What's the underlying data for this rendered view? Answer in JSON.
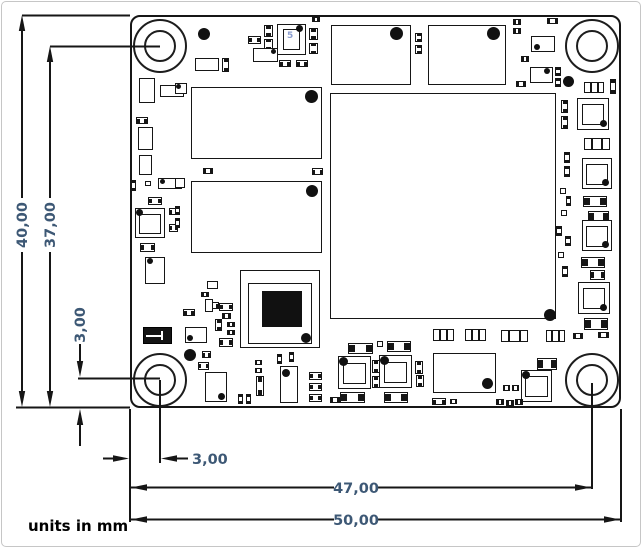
{
  "annotation": {
    "units_label": "units in mm",
    "dims": {
      "v_overall": "40,00",
      "v_hole_to_bottom": "37,00",
      "v_hole_offset": "3,00",
      "h_hole_offset": "3,00",
      "h_edge_to_hole": "47,00",
      "h_overall": "50,00"
    }
  },
  "colors": {
    "dimension_text": "#3d5875",
    "outline": "#161616",
    "background": "#ffffff",
    "chip_marking": "#8d9fd1"
  },
  "pcb": {
    "board": {
      "x": 130,
      "y": 15,
      "w": 491,
      "h": 393,
      "width_mm": "50,00",
      "height_mm": "40,00",
      "hole_offset_mm": "3,00"
    },
    "holes": [
      {
        "cx": 160,
        "cy": 46
      },
      {
        "cx": 592,
        "cy": 46
      },
      {
        "cx": 160,
        "cy": 380
      },
      {
        "cx": 592,
        "cy": 380
      }
    ],
    "hole_outer_d": 54,
    "components": [
      {
        "t": "dot",
        "x": 204,
        "y": 34,
        "d": 12
      },
      {
        "t": "r",
        "x": 195,
        "y": 58,
        "w": 24,
        "h": 13
      },
      {
        "t": "c2v",
        "x": 222,
        "y": 58,
        "w": 7,
        "h": 14
      },
      {
        "t": "c2h",
        "x": 248,
        "y": 36,
        "w": 13,
        "h": 8
      },
      {
        "t": "c2v",
        "x": 264,
        "y": 25,
        "w": 9,
        "h": 12
      },
      {
        "t": "c2v",
        "x": 264,
        "y": 39,
        "w": 9,
        "h": 11
      },
      {
        "t": "r",
        "x": 277,
        "y": 24,
        "w": 29,
        "h": 31,
        "n": "oscillator"
      },
      {
        "t": "r",
        "x": 283,
        "y": 29,
        "w": 17,
        "h": 21
      },
      {
        "t": "txt",
        "x": 287,
        "y": 32,
        "s": "5",
        "n": "chip-marking"
      },
      {
        "t": "dot",
        "x": 299,
        "y": 28,
        "d": 7
      },
      {
        "t": "c2v",
        "x": 309,
        "y": 28,
        "w": 9,
        "h": 12
      },
      {
        "t": "c2v",
        "x": 309,
        "y": 43,
        "w": 9,
        "h": 11
      },
      {
        "t": "c2h",
        "x": 312,
        "y": 17,
        "w": 8,
        "h": 5
      },
      {
        "t": "r",
        "x": 253,
        "y": 48,
        "w": 25,
        "h": 14
      },
      {
        "t": "dot",
        "x": 273,
        "y": 51,
        "d": 5
      },
      {
        "t": "c2h",
        "x": 279,
        "y": 60,
        "w": 12,
        "h": 7
      },
      {
        "t": "c2h",
        "x": 296,
        "y": 60,
        "w": 12,
        "h": 7
      },
      {
        "t": "r",
        "x": 331,
        "y": 25,
        "w": 80,
        "h": 60,
        "n": "top-ic-1"
      },
      {
        "t": "dot",
        "x": 396,
        "y": 33,
        "d": 13
      },
      {
        "t": "c2v",
        "x": 415,
        "y": 33,
        "w": 7,
        "h": 9
      },
      {
        "t": "c2v",
        "x": 415,
        "y": 45,
        "w": 7,
        "h": 9
      },
      {
        "t": "r",
        "x": 428,
        "y": 25,
        "w": 78,
        "h": 60,
        "n": "top-ic-2"
      },
      {
        "t": "dot",
        "x": 493,
        "y": 33,
        "d": 13
      },
      {
        "t": "c2h",
        "x": 513,
        "y": 19,
        "w": 8,
        "h": 6
      },
      {
        "t": "c2h",
        "x": 513,
        "y": 28,
        "w": 8,
        "h": 6
      },
      {
        "t": "c2h",
        "x": 547,
        "y": 18,
        "w": 11,
        "h": 6
      },
      {
        "t": "r",
        "x": 531,
        "y": 36,
        "w": 24,
        "h": 16
      },
      {
        "t": "dot",
        "x": 537,
        "y": 47,
        "d": 6
      },
      {
        "t": "c2h",
        "x": 521,
        "y": 56,
        "w": 8,
        "h": 6
      },
      {
        "t": "r",
        "x": 530,
        "y": 67,
        "w": 23,
        "h": 16
      },
      {
        "t": "dot",
        "x": 547,
        "y": 71,
        "d": 6
      },
      {
        "t": "c2h",
        "x": 516,
        "y": 81,
        "w": 10,
        "h": 6
      },
      {
        "t": "c2v",
        "x": 555,
        "y": 67,
        "w": 6,
        "h": 9
      },
      {
        "t": "c2v",
        "x": 555,
        "y": 78,
        "w": 6,
        "h": 9
      },
      {
        "t": "dot",
        "x": 568,
        "y": 81,
        "d": 11
      },
      {
        "t": "c3h",
        "x": 584,
        "y": 82,
        "w": 20,
        "h": 11
      },
      {
        "t": "c2v",
        "x": 610,
        "y": 79,
        "w": 6,
        "h": 15
      },
      {
        "t": "r",
        "x": 191,
        "y": 87,
        "w": 131,
        "h": 72,
        "n": "memory-chip-1"
      },
      {
        "t": "dot",
        "x": 311,
        "y": 96,
        "d": 13
      },
      {
        "t": "r",
        "x": 191,
        "y": 181,
        "w": 131,
        "h": 72,
        "n": "memory-chip-2"
      },
      {
        "t": "dot",
        "x": 312,
        "y": 191,
        "d": 12
      },
      {
        "t": "r",
        "x": 330,
        "y": 93,
        "w": 226,
        "h": 226,
        "n": "soc-chip"
      },
      {
        "t": "dot",
        "x": 550,
        "y": 315,
        "d": 12
      },
      {
        "t": "r",
        "x": 139,
        "y": 78,
        "w": 16,
        "h": 25
      },
      {
        "t": "r",
        "x": 160,
        "y": 85,
        "w": 24,
        "h": 12
      },
      {
        "t": "dot",
        "x": 178,
        "y": 88,
        "d": 5
      },
      {
        "t": "c2h",
        "x": 136,
        "y": 117,
        "w": 12,
        "h": 7
      },
      {
        "t": "r",
        "x": 138,
        "y": 127,
        "w": 15,
        "h": 23
      },
      {
        "t": "r",
        "x": 139,
        "y": 155,
        "w": 13,
        "h": 20
      },
      {
        "t": "c2v",
        "x": 131,
        "y": 180,
        "w": 5,
        "h": 11
      },
      {
        "t": "r",
        "x": 145,
        "y": 181,
        "w": 6,
        "h": 5
      },
      {
        "t": "r",
        "x": 158,
        "y": 178,
        "w": 24,
        "h": 11
      },
      {
        "t": "dot",
        "x": 162,
        "y": 181,
        "d": 5
      },
      {
        "t": "c2h",
        "x": 148,
        "y": 197,
        "w": 14,
        "h": 8
      },
      {
        "t": "ind",
        "x": 135,
        "y": 208,
        "w": 30,
        "h": 30
      },
      {
        "t": "dot",
        "x": 139,
        "y": 212,
        "d": 7
      },
      {
        "t": "c2h",
        "x": 169,
        "y": 208,
        "w": 9,
        "h": 7
      },
      {
        "t": "c2h",
        "x": 169,
        "y": 224,
        "w": 9,
        "h": 8
      },
      {
        "t": "c2h",
        "x": 140,
        "y": 243,
        "w": 15,
        "h": 9
      },
      {
        "t": "r",
        "x": 145,
        "y": 257,
        "w": 20,
        "h": 27
      },
      {
        "t": "dot",
        "x": 150,
        "y": 261,
        "d": 6
      },
      {
        "t": "r",
        "x": 175,
        "y": 83,
        "w": 12,
        "h": 11
      },
      {
        "t": "dot",
        "x": 178,
        "y": 86,
        "d": 5
      },
      {
        "t": "c2h",
        "x": 203,
        "y": 168,
        "w": 10,
        "h": 6
      },
      {
        "t": "c2h",
        "x": 312,
        "y": 168,
        "w": 11,
        "h": 7
      },
      {
        "t": "r",
        "x": 175,
        "y": 178,
        "w": 10,
        "h": 10
      },
      {
        "t": "c2v",
        "x": 175,
        "y": 206,
        "w": 5,
        "h": 9
      },
      {
        "t": "c2v",
        "x": 175,
        "y": 218,
        "w": 5,
        "h": 10
      },
      {
        "t": "r",
        "x": 207,
        "y": 281,
        "w": 11,
        "h": 8
      },
      {
        "t": "c2h",
        "x": 201,
        "y": 292,
        "w": 8,
        "h": 5
      },
      {
        "t": "c2h",
        "x": 208,
        "y": 302,
        "w": 11,
        "h": 7
      },
      {
        "t": "xb",
        "x": 143,
        "y": 327,
        "w": 29,
        "h": 17,
        "n": "black-crystal"
      },
      {
        "t": "c2h",
        "x": 183,
        "y": 309,
        "w": 12,
        "h": 7
      },
      {
        "t": "r",
        "x": 205,
        "y": 299,
        "w": 8,
        "h": 13
      },
      {
        "t": "c2h",
        "x": 219,
        "y": 303,
        "w": 14,
        "h": 8
      },
      {
        "t": "c2h",
        "x": 222,
        "y": 313,
        "w": 9,
        "h": 6
      },
      {
        "t": "c2v",
        "x": 215,
        "y": 319,
        "w": 7,
        "h": 12
      },
      {
        "t": "c2h",
        "x": 227,
        "y": 322,
        "w": 8,
        "h": 5
      },
      {
        "t": "c2h",
        "x": 227,
        "y": 330,
        "w": 8,
        "h": 5
      },
      {
        "t": "r",
        "x": 185,
        "y": 327,
        "w": 22,
        "h": 16
      },
      {
        "t": "dot",
        "x": 190,
        "y": 338,
        "d": 6
      },
      {
        "t": "c2h",
        "x": 219,
        "y": 338,
        "w": 14,
        "h": 9
      },
      {
        "t": "dot",
        "x": 190,
        "y": 355,
        "d": 12
      },
      {
        "t": "c2h",
        "x": 202,
        "y": 351,
        "w": 9,
        "h": 7
      },
      {
        "t": "c2h",
        "x": 198,
        "y": 362,
        "w": 11,
        "h": 8
      },
      {
        "t": "r",
        "x": 205,
        "y": 372,
        "w": 22,
        "h": 30
      },
      {
        "t": "dot",
        "x": 221,
        "y": 396,
        "d": 7
      },
      {
        "t": "c2v",
        "x": 238,
        "y": 394,
        "w": 5,
        "h": 10
      },
      {
        "t": "c2v",
        "x": 246,
        "y": 394,
        "w": 5,
        "h": 10
      },
      {
        "t": "c2h",
        "x": 255,
        "y": 360,
        "w": 7,
        "h": 5
      },
      {
        "t": "c2h",
        "x": 255,
        "y": 368,
        "w": 7,
        "h": 5
      },
      {
        "t": "c2v",
        "x": 256,
        "y": 376,
        "w": 8,
        "h": 20
      },
      {
        "t": "c2v",
        "x": 277,
        "y": 354,
        "w": 5,
        "h": 10
      },
      {
        "t": "c2v",
        "x": 289,
        "y": 352,
        "w": 5,
        "h": 10
      },
      {
        "t": "r",
        "x": 280,
        "y": 366,
        "w": 18,
        "h": 37
      },
      {
        "t": "dot",
        "x": 286,
        "y": 373,
        "d": 8
      },
      {
        "t": "c2h",
        "x": 309,
        "y": 372,
        "w": 13,
        "h": 8
      },
      {
        "t": "c2h",
        "x": 309,
        "y": 383,
        "w": 13,
        "h": 8
      },
      {
        "t": "c2h",
        "x": 309,
        "y": 394,
        "w": 13,
        "h": 8
      },
      {
        "t": "c2h",
        "x": 330,
        "y": 397,
        "w": 10,
        "h": 6
      },
      {
        "t": "c2h",
        "x": 345,
        "y": 398,
        "w": 7,
        "h": 5
      },
      {
        "t": "r",
        "x": 240,
        "y": 270,
        "w": 80,
        "h": 78,
        "n": "black-chip-outer"
      },
      {
        "t": "r",
        "x": 248,
        "y": 283,
        "w": 64,
        "h": 61,
        "n": "black-chip-inner"
      },
      {
        "t": "rf",
        "x": 262,
        "y": 291,
        "w": 40,
        "h": 36,
        "n": "black-chip-die"
      },
      {
        "t": "dot",
        "x": 306,
        "y": 338,
        "d": 10
      },
      {
        "t": "c3h",
        "x": 433,
        "y": 329,
        "w": 21,
        "h": 12
      },
      {
        "t": "c3h",
        "x": 465,
        "y": 329,
        "w": 21,
        "h": 12
      },
      {
        "t": "c2h",
        "x": 348,
        "y": 343,
        "w": 25,
        "h": 11
      },
      {
        "t": "r",
        "x": 377,
        "y": 341,
        "w": 6,
        "h": 6
      },
      {
        "t": "c2h",
        "x": 387,
        "y": 341,
        "w": 24,
        "h": 11
      },
      {
        "t": "ind",
        "x": 338,
        "y": 356,
        "w": 33,
        "h": 33
      },
      {
        "t": "dot",
        "x": 343,
        "y": 361,
        "d": 9
      },
      {
        "t": "ind",
        "x": 379,
        "y": 355,
        "w": 33,
        "h": 33
      },
      {
        "t": "dot",
        "x": 384,
        "y": 360,
        "d": 9
      },
      {
        "t": "c2v",
        "x": 372,
        "y": 360,
        "w": 8,
        "h": 13
      },
      {
        "t": "c2v",
        "x": 372,
        "y": 376,
        "w": 8,
        "h": 12
      },
      {
        "t": "c2v",
        "x": 415,
        "y": 361,
        "w": 8,
        "h": 13
      },
      {
        "t": "c2v",
        "x": 416,
        "y": 375,
        "w": 8,
        "h": 12
      },
      {
        "t": "c2h",
        "x": 340,
        "y": 392,
        "w": 25,
        "h": 11
      },
      {
        "t": "c2h",
        "x": 384,
        "y": 392,
        "w": 24,
        "h": 11
      },
      {
        "t": "r",
        "x": 433,
        "y": 353,
        "w": 63,
        "h": 40,
        "n": "bottom-ic"
      },
      {
        "t": "dot",
        "x": 487,
        "y": 383,
        "d": 11
      },
      {
        "t": "c2h",
        "x": 432,
        "y": 398,
        "w": 14,
        "h": 7
      },
      {
        "t": "c2h",
        "x": 450,
        "y": 399,
        "w": 7,
        "h": 5
      },
      {
        "t": "c3h",
        "x": 501,
        "y": 330,
        "w": 27,
        "h": 12
      },
      {
        "t": "c3h",
        "x": 546,
        "y": 330,
        "w": 19,
        "h": 12
      },
      {
        "t": "c2h",
        "x": 573,
        "y": 333,
        "w": 10,
        "h": 6
      },
      {
        "t": "c2h",
        "x": 537,
        "y": 358,
        "w": 20,
        "h": 12
      },
      {
        "t": "ind",
        "x": 521,
        "y": 370,
        "w": 31,
        "h": 32
      },
      {
        "t": "dot",
        "x": 526,
        "y": 375,
        "d": 8
      },
      {
        "t": "c2h",
        "x": 503,
        "y": 385,
        "w": 7,
        "h": 6
      },
      {
        "t": "c2h",
        "x": 512,
        "y": 385,
        "w": 7,
        "h": 6
      },
      {
        "t": "c2h",
        "x": 496,
        "y": 399,
        "w": 8,
        "h": 6
      },
      {
        "t": "c2h",
        "x": 506,
        "y": 400,
        "w": 8,
        "h": 6
      },
      {
        "t": "c2h",
        "x": 515,
        "y": 399,
        "w": 8,
        "h": 6
      },
      {
        "t": "ind",
        "x": 577,
        "y": 98,
        "w": 32,
        "h": 32
      },
      {
        "t": "dot",
        "x": 603,
        "y": 123,
        "d": 7
      },
      {
        "t": "c3h",
        "x": 584,
        "y": 138,
        "w": 26,
        "h": 12
      },
      {
        "t": "ind",
        "x": 582,
        "y": 158,
        "w": 30,
        "h": 31
      },
      {
        "t": "dot",
        "x": 605,
        "y": 182,
        "d": 7
      },
      {
        "t": "c2h",
        "x": 583,
        "y": 196,
        "w": 24,
        "h": 11
      },
      {
        "t": "c2h",
        "x": 588,
        "y": 211,
        "w": 21,
        "h": 11
      },
      {
        "t": "ind",
        "x": 582,
        "y": 220,
        "w": 30,
        "h": 31
      },
      {
        "t": "dot",
        "x": 605,
        "y": 244,
        "d": 7
      },
      {
        "t": "c2h",
        "x": 581,
        "y": 257,
        "w": 24,
        "h": 11
      },
      {
        "t": "c2h",
        "x": 590,
        "y": 270,
        "w": 15,
        "h": 10
      },
      {
        "t": "ind",
        "x": 578,
        "y": 282,
        "w": 32,
        "h": 32
      },
      {
        "t": "dot",
        "x": 603,
        "y": 307,
        "d": 7
      },
      {
        "t": "c2h",
        "x": 584,
        "y": 318,
        "w": 24,
        "h": 12
      },
      {
        "t": "c2h",
        "x": 598,
        "y": 332,
        "w": 11,
        "h": 6
      },
      {
        "t": "c2v",
        "x": 561,
        "y": 100,
        "w": 7,
        "h": 13
      },
      {
        "t": "c2v",
        "x": 561,
        "y": 116,
        "w": 7,
        "h": 13
      },
      {
        "t": "c2v",
        "x": 564,
        "y": 152,
        "w": 6,
        "h": 11
      },
      {
        "t": "c2v",
        "x": 564,
        "y": 166,
        "w": 6,
        "h": 11
      },
      {
        "t": "r",
        "x": 560,
        "y": 188,
        "w": 6,
        "h": 6
      },
      {
        "t": "c2v",
        "x": 566,
        "y": 196,
        "w": 5,
        "h": 10
      },
      {
        "t": "r",
        "x": 561,
        "y": 210,
        "w": 6,
        "h": 6
      },
      {
        "t": "c2v",
        "x": 556,
        "y": 226,
        "w": 6,
        "h": 10
      },
      {
        "t": "c2v",
        "x": 565,
        "y": 236,
        "w": 6,
        "h": 10
      },
      {
        "t": "r",
        "x": 558,
        "y": 252,
        "w": 6,
        "h": 6
      },
      {
        "t": "c2v",
        "x": 562,
        "y": 266,
        "w": 6,
        "h": 11
      }
    ]
  }
}
